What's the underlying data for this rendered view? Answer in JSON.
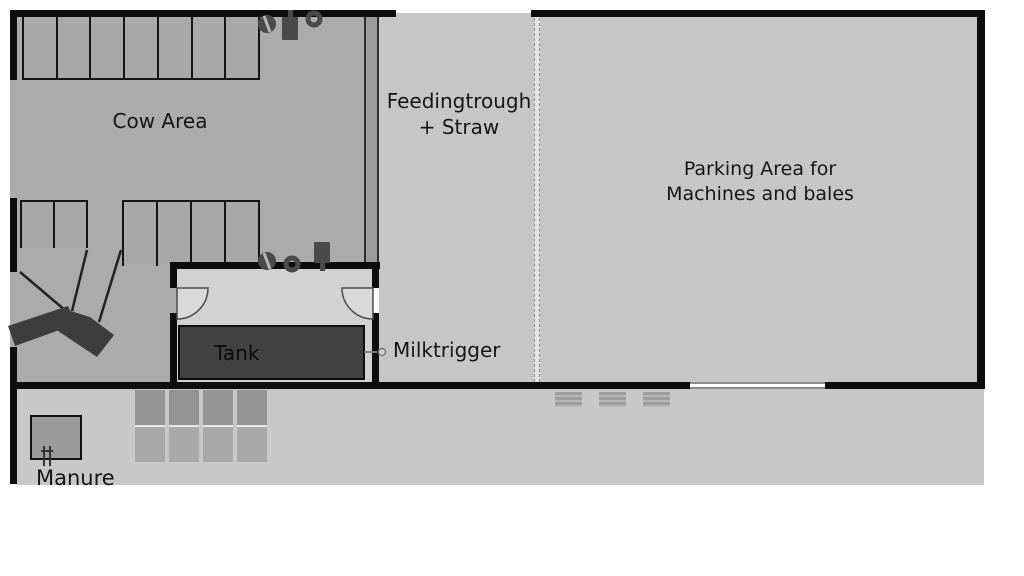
{
  "areas": {
    "cow": {
      "label": "Cow Area"
    },
    "feeding": {
      "line1": "Feedingtrough",
      "line2": "+ Straw"
    },
    "parking": {
      "line1": "Parking Area for",
      "line2": "Machines and bales"
    },
    "tank": {
      "label": "Tank"
    },
    "milktrigger": {
      "label": "Milktrigger"
    },
    "manure": {
      "label": "Manure"
    }
  },
  "stalls": {
    "top_row": {
      "count": 7
    },
    "bottom_left": {
      "count": 2
    },
    "bottom_right": {
      "count": 4
    }
  },
  "bales": {
    "columns": 4,
    "rows_per_column": 2
  },
  "parking_markers": {
    "count": 3
  },
  "equipment": {
    "cow_area_top": [
      "water-bowl-icon",
      "brush-icon",
      "ring-icon"
    ],
    "cow_area_bottom": [
      "water-bowl-icon",
      "ring-icon",
      "brush-icon"
    ],
    "manure": "fork-icon",
    "tank": "milk-line-connector",
    "scraper": "manure-scraper"
  },
  "colors": {
    "wall": "#0d0d0d",
    "cow_area": "#ababab",
    "feeding_area": "#c6c6c6",
    "parking_area": "#c6c6c6",
    "tank_room": "#d2d2d2",
    "yard": "#c8c8c8",
    "tank": "#424242",
    "equipment": "#4a4a4a"
  }
}
